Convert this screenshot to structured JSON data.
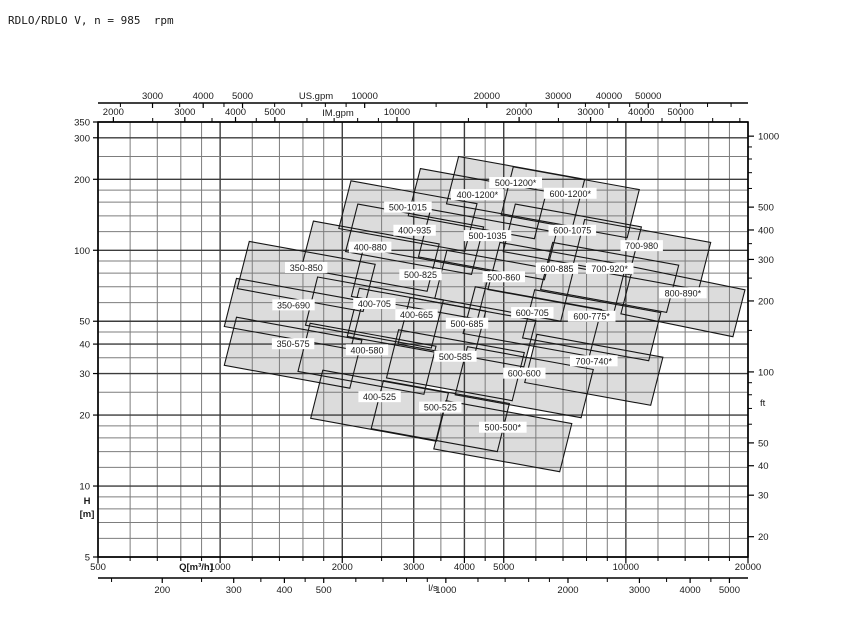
{
  "title": "RDLO/RDLO V, n = 985  rpm",
  "chart_data": {
    "type": "area",
    "description": "Pump selection range chart: overlapping operating envelopes (Q vs H, log-log) per pump size",
    "x_axis": {
      "label": "Q[m³/h]",
      "scale": "log",
      "range": [
        500,
        20000
      ],
      "labeled_ticks": [
        500,
        1000,
        2000,
        3000,
        4000,
        5000,
        10000,
        20000
      ],
      "grid_ticks": [
        500,
        600,
        700,
        800,
        900,
        1000,
        1200,
        1400,
        1600,
        1800,
        2000,
        2500,
        3000,
        3500,
        4000,
        4500,
        5000,
        6000,
        7000,
        8000,
        9000,
        10000,
        12000,
        14000,
        16000,
        18000,
        20000
      ]
    },
    "x_axis_ls": {
      "label": "l/s",
      "factor_to_m3h": 3.6,
      "labeled_ticks": [
        200,
        300,
        400,
        500,
        1000,
        2000,
        3000,
        4000,
        5000
      ],
      "minor_ticks": [
        150,
        250,
        350,
        450,
        600,
        700,
        800,
        900,
        1200,
        1400,
        1600,
        1800,
        2500,
        3500,
        4500
      ]
    },
    "x_axis_usgpm": {
      "label": "US.gpm",
      "factor_to_m3h": 0.2271,
      "labeled_ticks": [
        3000,
        4000,
        5000,
        10000,
        20000,
        30000,
        40000,
        50000
      ],
      "minor_ticks": [
        2500,
        3500,
        4500,
        6000,
        7000,
        8000,
        9000,
        15000,
        25000,
        35000,
        45000,
        60000,
        70000,
        80000
      ]
    },
    "x_axis_imgpm": {
      "label": "IM.gpm",
      "factor_to_m3h": 0.2728,
      "labeled_ticks": [
        2000,
        3000,
        4000,
        5000,
        10000,
        20000,
        30000,
        40000,
        50000
      ],
      "minor_ticks": [
        2500,
        3500,
        4500,
        6000,
        7000,
        8000,
        9000,
        15000,
        25000,
        35000,
        45000,
        60000,
        70000
      ]
    },
    "y_axis": {
      "label": "H",
      "unit": "[m]",
      "scale": "log",
      "range": [
        5,
        350
      ],
      "labeled_ticks": [
        350,
        300,
        200,
        100,
        50,
        40,
        30,
        20,
        10,
        5
      ],
      "grid_ticks": [
        5,
        6,
        7,
        8,
        9,
        10,
        12,
        14,
        16,
        18,
        20,
        25,
        30,
        35,
        40,
        45,
        50,
        60,
        70,
        80,
        90,
        100,
        120,
        140,
        160,
        180,
        200,
        250,
        300,
        350
      ]
    },
    "y_axis_ft": {
      "label": "ft",
      "factor_to_m": 0.3048,
      "labeled_ticks": [
        1000,
        500,
        400,
        300,
        200,
        100,
        50,
        40,
        30,
        20
      ],
      "minor_ticks": [
        900,
        800,
        700,
        600,
        350,
        250,
        150,
        90,
        80,
        70,
        60
      ]
    },
    "models": [
      {
        "label": "350-575",
        "q": [
          1060,
          2160
        ],
        "h": [
          26,
          52
        ]
      },
      {
        "label": "350-690",
        "q": [
          1060,
          2170
        ],
        "h": [
          38,
          76
        ]
      },
      {
        "label": "350-850",
        "q": [
          1140,
          2330
        ],
        "h": [
          55,
          109
        ]
      },
      {
        "label": "400-525",
        "q": [
          1730,
          3530
        ],
        "h": [
          15.5,
          31
        ]
      },
      {
        "label": "400-580",
        "q": [
          1610,
          3290
        ],
        "h": [
          24.5,
          49
        ]
      },
      {
        "label": "400-665",
        "q": [
          2130,
          4360
        ],
        "h": [
          34.5,
          69
        ]
      },
      {
        "label": "400-705",
        "q": [
          1680,
          3430
        ],
        "h": [
          38.5,
          77
        ]
      },
      {
        "label": "400-880",
        "q": [
          1640,
          3350
        ],
        "h": [
          67,
          133
        ]
      },
      {
        "label": "400-935",
        "q": [
          2110,
          4310
        ],
        "h": [
          79,
          157
        ]
      },
      {
        "label": "400-1200*",
        "q": [
          3010,
          6160
        ],
        "h": [
          112,
          222
        ]
      },
      {
        "label": "500-500*",
        "q": [
          3480,
          7110
        ],
        "h": [
          11.5,
          23
        ]
      },
      {
        "label": "500-525",
        "q": [
          2440,
          4990
        ],
        "h": [
          14,
          28
        ]
      },
      {
        "label": "500-585",
        "q": [
          2660,
          5430
        ],
        "h": [
          23,
          46
        ]
      },
      {
        "label": "500-685",
        "q": [
          2840,
          5800
        ],
        "h": [
          32,
          63
        ]
      },
      {
        "label": "500-825",
        "q": [
          2180,
          4460
        ],
        "h": [
          51,
          102
        ]
      },
      {
        "label": "500-860",
        "q": [
          3500,
          7150
        ],
        "h": [
          50,
          100
        ]
      },
      {
        "label": "500-1015",
        "q": [
          2030,
          4150
        ],
        "h": [
          99,
          197
        ]
      },
      {
        "label": "500-1035",
        "q": [
          3190,
          6520
        ],
        "h": [
          75,
          149
        ]
      },
      {
        "label": "500-1200*",
        "q": [
          3740,
          7650
        ],
        "h": [
          126,
          250
        ]
      },
      {
        "label": "600-600",
        "q": [
          3930,
          8030
        ],
        "h": [
          19.5,
          39
        ]
      },
      {
        "label": "600-705",
        "q": [
          4110,
          8410
        ],
        "h": [
          35.5,
          70
        ]
      },
      {
        "label": "600-775*",
        "q": [
          5760,
          11780
        ],
        "h": [
          34,
          68
        ]
      },
      {
        "label": "600-885",
        "q": [
          4730,
          9670
        ],
        "h": [
          54.5,
          108
        ]
      },
      {
        "label": "600-1075",
        "q": [
          5160,
          10550
        ],
        "h": [
          79,
          157
        ]
      },
      {
        "label": "600-1200*",
        "q": [
          5100,
          10430
        ],
        "h": [
          113,
          226
        ]
      },
      {
        "label": "700-740*",
        "q": [
          5830,
          11920
        ],
        "h": [
          22,
          44
        ]
      },
      {
        "label": "700-920*",
        "q": [
          6380,
          13040
        ],
        "h": [
          54.5,
          108
        ]
      },
      {
        "label": "700-980",
        "q": [
          7650,
          15640
        ],
        "h": [
          68,
          135
        ]
      },
      {
        "label": "800-890*",
        "q": [
          10060,
          19000
        ],
        "h": [
          43,
          85
        ]
      }
    ]
  },
  "colors": {
    "background": "#ffffff",
    "tile_fill": "#dcdcdc",
    "tile_stroke": "#161616",
    "grid_major": "#3c3c3c",
    "grid_minor": "#7d7d7d",
    "axis": "#000000",
    "text": "#1a1a1a",
    "label_box": "#ffffff"
  }
}
